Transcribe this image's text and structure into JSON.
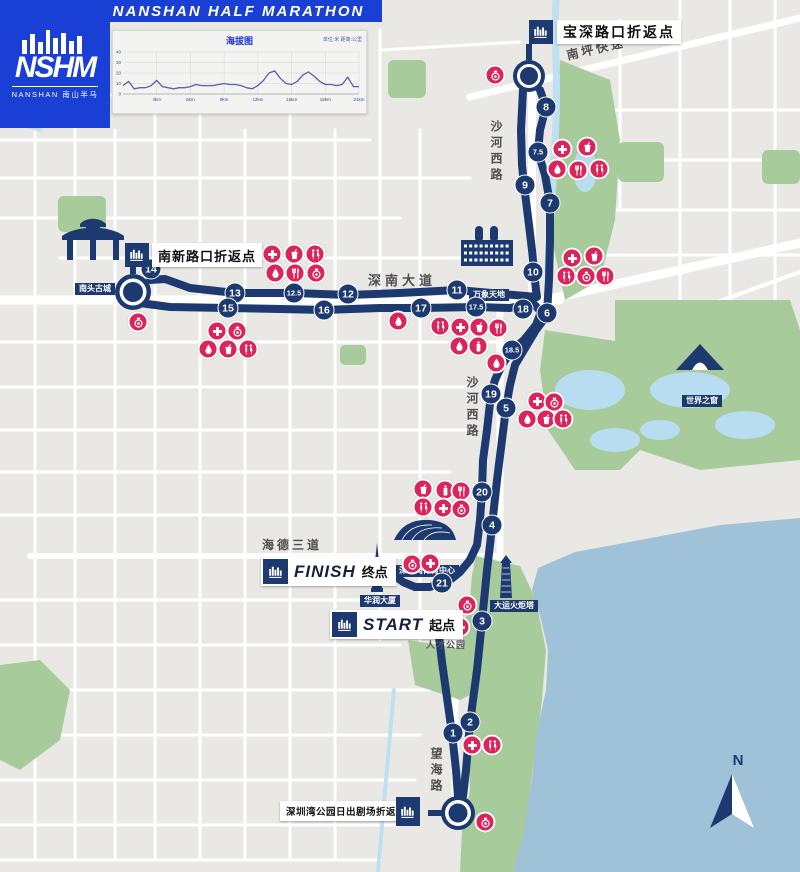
{
  "header": {
    "title": "SHENZHEN NANSHAN HALF MARATHON",
    "logo": {
      "acronym": "NSHM",
      "name_en": "NANSHAN",
      "name_cn": "南山半马"
    }
  },
  "chart_data": {
    "type": "line",
    "title": "海拔图",
    "unit_note": "单位:米 距离:公里",
    "x_start_km": 0,
    "x_step_km": 0.5,
    "elevation_m": [
      8,
      12,
      5,
      6,
      6,
      8,
      13,
      7,
      6,
      5,
      6,
      6,
      7,
      9,
      8,
      8,
      8,
      9,
      10,
      9,
      9,
      8,
      6,
      5,
      8,
      13,
      20,
      22,
      15,
      10,
      9,
      12,
      18,
      21,
      17,
      12,
      9,
      9,
      8,
      9,
      16,
      7,
      7
    ],
    "xlabel_ticks": [
      "3km",
      "6km",
      "9km",
      "12km",
      "15km",
      "18km",
      "21km"
    ],
    "xlabel_tick_km": [
      3,
      6,
      9,
      12,
      15,
      18,
      21
    ],
    "ylabel_ticks": [
      0,
      10,
      20,
      30,
      40
    ],
    "xlim": [
      0,
      21
    ],
    "ylim": [
      0,
      40
    ],
    "line_color": "#5b5fae",
    "grid": true,
    "legend": false
  },
  "map": {
    "compass": {
      "label": "N"
    },
    "roads": [
      {
        "id": "nanping",
        "label": "南坪快速"
      },
      {
        "id": "shahe-north",
        "label": "沙河西路"
      },
      {
        "id": "shennan",
        "label": "深南大道"
      },
      {
        "id": "shahe-south",
        "label": "沙河西路"
      },
      {
        "id": "haide",
        "label": "海德三道"
      },
      {
        "id": "wanghai",
        "label": "望海路"
      },
      {
        "id": "talent-park",
        "label": "人才公园"
      }
    ],
    "landmarks": [
      {
        "id": "nantou",
        "label": "南头古城"
      },
      {
        "id": "mixc",
        "label": "万象天地"
      },
      {
        "id": "window-of-world",
        "label": "世界之窗"
      },
      {
        "id": "sports-center",
        "label": "深圳湾体育中心"
      },
      {
        "id": "cr-tower",
        "label": "华润大厦"
      },
      {
        "id": "torch-tower",
        "label": "大运火炬塔"
      }
    ],
    "turnarounds": [
      {
        "id": "baoshen",
        "label": "宝深路口折返点"
      },
      {
        "id": "nanxin",
        "label": "南新路口折返点"
      },
      {
        "id": "sunrise",
        "label": "深圳湾公园日出剧场折返点"
      }
    ],
    "start": {
      "en": "START",
      "cn": "起点"
    },
    "finish": {
      "en": "FINISH",
      "cn": "终点"
    },
    "km_markers": [
      {
        "label": "1",
        "x": 453,
        "y": 733
      },
      {
        "label": "2",
        "x": 470,
        "y": 722
      },
      {
        "label": "3",
        "x": 482,
        "y": 621
      },
      {
        "label": "4",
        "x": 492,
        "y": 525
      },
      {
        "label": "5",
        "x": 506,
        "y": 408
      },
      {
        "label": "6",
        "x": 547,
        "y": 313
      },
      {
        "label": "7",
        "x": 550,
        "y": 203
      },
      {
        "label": "7.5",
        "x": 538,
        "y": 152
      },
      {
        "label": "8",
        "x": 546,
        "y": 107
      },
      {
        "label": "9",
        "x": 525,
        "y": 185
      },
      {
        "label": "10",
        "x": 533,
        "y": 272
      },
      {
        "label": "11",
        "x": 457,
        "y": 290
      },
      {
        "label": "12",
        "x": 348,
        "y": 294
      },
      {
        "label": "12.5",
        "x": 294,
        "y": 293
      },
      {
        "label": "13",
        "x": 235,
        "y": 293
      },
      {
        "label": "14",
        "x": 151,
        "y": 269
      },
      {
        "label": "15",
        "x": 228,
        "y": 308
      },
      {
        "label": "16",
        "x": 324,
        "y": 310
      },
      {
        "label": "17",
        "x": 421,
        "y": 308
      },
      {
        "label": "17.5",
        "x": 476,
        "y": 307
      },
      {
        "label": "18",
        "x": 523,
        "y": 309
      },
      {
        "label": "18.5",
        "x": 512,
        "y": 350
      },
      {
        "label": "19",
        "x": 491,
        "y": 394
      },
      {
        "label": "20",
        "x": 482,
        "y": 492
      },
      {
        "label": "21",
        "x": 442,
        "y": 583
      }
    ],
    "stations": [
      {
        "type": "camera",
        "x": 495,
        "y": 75
      },
      {
        "type": "medical",
        "x": 562,
        "y": 149
      },
      {
        "type": "drink",
        "x": 587,
        "y": 147
      },
      {
        "type": "sponge",
        "x": 557,
        "y": 169
      },
      {
        "type": "food",
        "x": 578,
        "y": 170
      },
      {
        "type": "toilet",
        "x": 599,
        "y": 169
      },
      {
        "type": "medical",
        "x": 572,
        "y": 258
      },
      {
        "type": "drink",
        "x": 594,
        "y": 256
      },
      {
        "type": "toilet",
        "x": 566,
        "y": 276
      },
      {
        "type": "camera",
        "x": 586,
        "y": 276
      },
      {
        "type": "food",
        "x": 605,
        "y": 276
      },
      {
        "type": "camera",
        "x": 138,
        "y": 322
      },
      {
        "type": "medical",
        "x": 272,
        "y": 254
      },
      {
        "type": "drink",
        "x": 294,
        "y": 254
      },
      {
        "type": "toilet",
        "x": 315,
        "y": 254
      },
      {
        "type": "sponge",
        "x": 275,
        "y": 273
      },
      {
        "type": "food",
        "x": 295,
        "y": 273
      },
      {
        "type": "camera",
        "x": 316,
        "y": 273
      },
      {
        "type": "medical",
        "x": 217,
        "y": 331
      },
      {
        "type": "camera",
        "x": 237,
        "y": 331
      },
      {
        "type": "sponge",
        "x": 208,
        "y": 349
      },
      {
        "type": "drink",
        "x": 228,
        "y": 349
      },
      {
        "type": "toilet",
        "x": 248,
        "y": 349
      },
      {
        "type": "sponge",
        "x": 398,
        "y": 321
      },
      {
        "type": "toilet",
        "x": 440,
        "y": 326
      },
      {
        "type": "medical",
        "x": 460,
        "y": 327
      },
      {
        "type": "drink",
        "x": 479,
        "y": 327
      },
      {
        "type": "food",
        "x": 498,
        "y": 328
      },
      {
        "type": "sponge",
        "x": 459,
        "y": 346
      },
      {
        "type": "water",
        "x": 478,
        "y": 346
      },
      {
        "type": "sponge",
        "x": 496,
        "y": 363
      },
      {
        "type": "medical",
        "x": 537,
        "y": 401
      },
      {
        "type": "camera",
        "x": 554,
        "y": 402
      },
      {
        "type": "sponge",
        "x": 527,
        "y": 419
      },
      {
        "type": "drink",
        "x": 546,
        "y": 419
      },
      {
        "type": "toilet",
        "x": 563,
        "y": 419
      },
      {
        "type": "drink",
        "x": 423,
        "y": 489
      },
      {
        "type": "water",
        "x": 445,
        "y": 490
      },
      {
        "type": "food",
        "x": 461,
        "y": 491
      },
      {
        "type": "toilet",
        "x": 423,
        "y": 507
      },
      {
        "type": "medical",
        "x": 443,
        "y": 508
      },
      {
        "type": "camera",
        "x": 461,
        "y": 509
      },
      {
        "type": "camera",
        "x": 412,
        "y": 564
      },
      {
        "type": "medical",
        "x": 430,
        "y": 563
      },
      {
        "type": "camera",
        "x": 467,
        "y": 605
      },
      {
        "type": "medical",
        "x": 460,
        "y": 627
      },
      {
        "type": "medical",
        "x": 472,
        "y": 745
      },
      {
        "type": "toilet",
        "x": 492,
        "y": 745
      },
      {
        "type": "camera",
        "x": 485,
        "y": 822
      }
    ],
    "colors": {
      "route_navy": "#1c3a70",
      "station_pink": "#d9255b",
      "header_blue": "#1a3fd4",
      "park_green": "#a8cb9c",
      "sea_blue": "#9fc2d8",
      "lake_blue": "#b9ddf0",
      "map_gray": "#e9e8e5"
    }
  }
}
